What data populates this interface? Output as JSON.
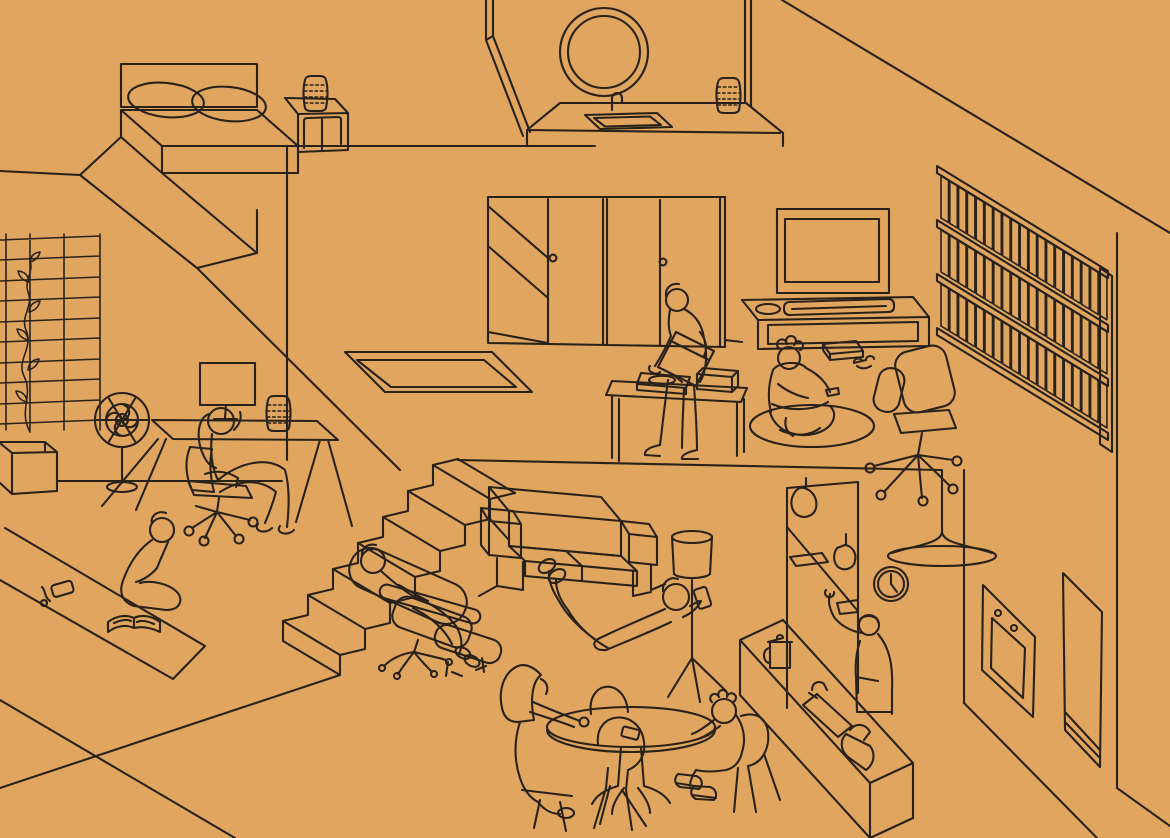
{
  "title": "Isometric line-art cutaway of a two-story home where people relax without screens",
  "meta": {
    "style": "single-weight isometric line illustration",
    "width": 1170,
    "height": 838
  },
  "palette": {
    "background": "#e0a55f",
    "line": "#29221a"
  },
  "scene": {
    "label": "Cutaway of a two-story home with nine people relaxing",
    "rooms": [
      {
        "id": "bedroom",
        "label": "Bedroom: platform bed with two pillows, headboard, nightstand with a stack of books"
      },
      {
        "id": "bathroom",
        "label": "Bathroom: round mirror, counter with inset basin, small faucet, folded towel stack"
      },
      {
        "id": "hallway",
        "label": "Upper hallway: sliding closet doors with round pulls, stairwell opening in the floor"
      },
      {
        "id": "media-room",
        "label": "Media room: wall-mounted TV, low console with speaker and soundbar, game box and controller on the floor, kid playing on a round rug, swivel office chair, person putting a record on a turntable table, full bookshelf wall"
      },
      {
        "id": "studio",
        "label": "Double-height studio: trestle desk with monitor and paper stack, person on a call in a task chair, pedestal fan, plant trellis on the wall, low planter bench"
      },
      {
        "id": "lounge",
        "label": "Lounge: staircase, reclined person in a lounge chair with ottoman, two-seat sofa, person lying on the floor holding a phone, tripod floor lamp, person reading a book on a long mat with phone and earbuds set aside"
      },
      {
        "id": "dining",
        "label": "Dining corner: round pedestal table, shell chairs, adult reaching across to a kid with sneakers, phone lying on the table"
      },
      {
        "id": "kitchen",
        "label": "Kitchen: open shelf unit with hanging plants, wall clock, trumpet pendant lamp, person reaching to a shelf, island with french press, inset sink, faucet and kettle, wall oven with two knobs, tall cabinet"
      }
    ],
    "people": [
      {
        "id": "desk-worker",
        "activity": "sitting in a task chair at the desk, hand raised to ear"
      },
      {
        "id": "mat-reader",
        "activity": "sitting cross-legged on a mat reading an open book"
      },
      {
        "id": "lounger",
        "activity": "reclining in the lounge chair, feet up on the ottoman"
      },
      {
        "id": "floor-lounger",
        "activity": "lying on the floor, feet propped on the sofa, holding a phone overhead"
      },
      {
        "id": "dj",
        "activity": "standing at a side table placing a vinyl record on the turntable"
      },
      {
        "id": "gaming-kid",
        "activity": "kid sitting on a round rug playing with a controller"
      },
      {
        "id": "kitchen-person",
        "activity": "standing at the island reaching up to an open shelf"
      },
      {
        "id": "dining-adult",
        "activity": "seated at the round table, arm stretched across it"
      },
      {
        "id": "dining-kid",
        "activity": "kid seated at the table, elbows up, wearing sneakers"
      }
    ],
    "objects": {
      "bedroom": [
        "bed",
        "pillows",
        "headboard",
        "nightstand",
        "book-stack"
      ],
      "bathroom": [
        "round-mirror",
        "counter",
        "basin",
        "faucet",
        "towel-stack"
      ],
      "hallway": [
        "sliding-doors",
        "door-pulls",
        "stairwell-railing"
      ],
      "media_room": [
        "tv",
        "console",
        "speaker",
        "soundbar",
        "floor-box",
        "controller",
        "round-rug",
        "office-chair",
        "bookshelf",
        "books",
        "turntable-table",
        "turntable",
        "record-crate"
      ],
      "studio": [
        "desk",
        "monitor",
        "paper-stack",
        "task-chair",
        "pedestal-fan",
        "trellis",
        "vine",
        "planter-bench"
      ],
      "lounge": [
        "staircase",
        "lounge-chair",
        "ottoman",
        "sofa",
        "floor-lamp",
        "mat",
        "open-book",
        "phone",
        "earbuds"
      ],
      "dining": [
        "round-table",
        "pedestal-base",
        "shell-chairs",
        "phone-on-table"
      ],
      "kitchen": [
        "shelf-unit",
        "hanging-plants",
        "wall-clock",
        "pendant-lamp",
        "island",
        "french-press",
        "sink",
        "faucet",
        "kettle",
        "wall-oven",
        "oven-knobs",
        "tall-cabinet"
      ]
    }
  }
}
